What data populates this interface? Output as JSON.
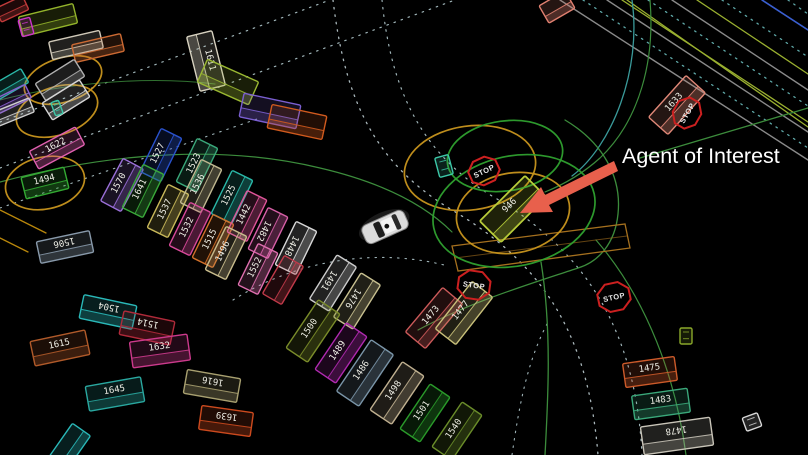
{
  "scene": {
    "background": "#000000",
    "description_label": "Agent of Interest"
  },
  "annotation": {
    "label": "Agent of Interest",
    "text_color": "#ffffff",
    "arrow_color": "#e8604c"
  },
  "colors": {
    "highlight_yellow": "#c8951e",
    "highlight_green": "#2fa12f",
    "stop_red": "#cc2020",
    "lane_dot": "#9fb4b8",
    "lane_green": "#3c8c3c",
    "lane_teal": "#3a9a9a",
    "lane_yellowgreen": "#9ab030",
    "lane_blue": "#3a5fd0",
    "lane_gray": "#8a8a8a",
    "crosswalk_orange": "#a5701e"
  },
  "ego": {
    "x": 385,
    "y": 227,
    "rot": 156
  },
  "stop_signs": [
    {
      "label": "STOP",
      "x": 484,
      "y": 171,
      "rot": -25,
      "r": 14
    },
    {
      "label": "STOP",
      "x": 474,
      "y": 285,
      "rot": 8,
      "r": 15
    },
    {
      "label": "STOP",
      "x": 614,
      "y": 297,
      "rot": -12,
      "r": 15
    },
    {
      "label": "STOP",
      "x": 687,
      "y": 113,
      "rot": -60,
      "r": 14
    }
  ],
  "highlight_ellipses": [
    {
      "x": 63,
      "y": 80,
      "rx": 40,
      "ry": 22,
      "rot": -18,
      "color": "#c8951e"
    },
    {
      "x": 57,
      "y": 111,
      "rx": 42,
      "ry": 24,
      "rot": -18,
      "color": "#c8951e"
    },
    {
      "x": 45,
      "y": 183,
      "rx": 40,
      "ry": 26,
      "rot": -12,
      "color": "#c8951e"
    },
    {
      "x": 470,
      "y": 168,
      "rx": 66,
      "ry": 42,
      "rot": -8,
      "color": "#c8951e"
    },
    {
      "x": 513,
      "y": 213,
      "rx": 57,
      "ry": 40,
      "rot": -10,
      "color": "#c8951e"
    },
    {
      "x": 514,
      "y": 211,
      "rx": 82,
      "ry": 55,
      "rot": -12,
      "color": "#2fa12f"
    },
    {
      "x": 505,
      "y": 156,
      "rx": 58,
      "ry": 35,
      "rot": -8,
      "color": "#2fa12f"
    }
  ],
  "agents": [
    {
      "id": "",
      "x": 12,
      "y": 9,
      "w": 30,
      "h": 15,
      "rot": -25,
      "color": "#c03a3a"
    },
    {
      "id": "",
      "x": 48,
      "y": 20,
      "w": 56,
      "h": 20,
      "rot": -14,
      "color": "#93b32b"
    },
    {
      "id": "",
      "x": 26,
      "y": 27,
      "w": 12,
      "h": 17,
      "rot": -15,
      "color": "#cc33cc"
    },
    {
      "id": "",
      "x": 76,
      "y": 45,
      "w": 52,
      "h": 18,
      "rot": -13,
      "color": "#cfc8b8"
    },
    {
      "id": "",
      "x": 98,
      "y": 48,
      "w": 50,
      "h": 18,
      "rot": -13,
      "color": "#cc6a33"
    },
    {
      "id": "",
      "x": 60,
      "y": 80,
      "w": 46,
      "h": 20,
      "rot": -32,
      "color": "#b0b0b0"
    },
    {
      "id": "",
      "x": 66,
      "y": 100,
      "w": 44,
      "h": 20,
      "rot": -32,
      "color": "#d5d5d5"
    },
    {
      "id": "",
      "x": 57,
      "y": 108,
      "w": 8,
      "h": 14,
      "rot": -20,
      "color": "#3cc8a8"
    },
    {
      "id": "",
      "x": 10,
      "y": 84,
      "w": 34,
      "h": 16,
      "rot": -30,
      "color": "#2ab8a8"
    },
    {
      "id": "",
      "x": 12,
      "y": 99,
      "w": 36,
      "h": 15,
      "rot": -26,
      "color": "#8a5fd0"
    },
    {
      "id": "",
      "x": 14,
      "y": 112,
      "w": 38,
      "h": 15,
      "rot": -22,
      "color": "#cfcfcf"
    },
    {
      "id": "1622",
      "x": 57,
      "y": 148,
      "w": 52,
      "h": 20,
      "rot": -28,
      "color": "#e060b0"
    },
    {
      "id": "1494",
      "x": 45,
      "y": 183,
      "w": 44,
      "h": 22,
      "rot": -14,
      "color": "#33aa33"
    },
    {
      "id": "1506",
      "x": 65,
      "y": 247,
      "w": 54,
      "h": 22,
      "rot": -12,
      "color": "#8899aa",
      "flip": true
    },
    {
      "id": "1611",
      "x": 206,
      "y": 61,
      "w": 56,
      "h": 26,
      "rot": 76,
      "color": "#d8d2c0"
    },
    {
      "id": "",
      "x": 228,
      "y": 82,
      "w": 56,
      "h": 25,
      "rot": 24,
      "color": "#9ab832"
    },
    {
      "id": "",
      "x": 270,
      "y": 111,
      "w": 58,
      "h": 24,
      "rot": 12,
      "color": "#7a5fd0"
    },
    {
      "id": "",
      "x": 297,
      "y": 122,
      "w": 56,
      "h": 24,
      "rot": 12,
      "color": "#d05a1e"
    },
    {
      "id": "",
      "x": 557,
      "y": 7,
      "w": 30,
      "h": 20,
      "rot": -30,
      "color": "#e08070"
    },
    {
      "id": "1570",
      "x": 122,
      "y": 185,
      "w": 48,
      "h": 23,
      "rot": -62,
      "color": "#9a6fd8"
    },
    {
      "id": "1527",
      "x": 161,
      "y": 155,
      "w": 48,
      "h": 23,
      "rot": -64,
      "color": "#2a52cc"
    },
    {
      "id": "1523",
      "x": 197,
      "y": 165,
      "w": 48,
      "h": 23,
      "rot": -64,
      "color": "#3aa87a"
    },
    {
      "id": "1641",
      "x": 143,
      "y": 191,
      "w": 48,
      "h": 23,
      "rot": -64,
      "color": "#3aa83a"
    },
    {
      "id": "1537",
      "x": 168,
      "y": 211,
      "w": 48,
      "h": 23,
      "rot": -64,
      "color": "#c8b85a"
    },
    {
      "id": "1536",
      "x": 201,
      "y": 186,
      "w": 48,
      "h": 23,
      "rot": -64,
      "color": "#c0b890"
    },
    {
      "id": "1525",
      "x": 232,
      "y": 197,
      "w": 48,
      "h": 23,
      "rot": -64,
      "color": "#2ab8a8"
    },
    {
      "id": "1532",
      "x": 190,
      "y": 229,
      "w": 48,
      "h": 23,
      "rot": -64,
      "color": "#d84a9a"
    },
    {
      "id": "1515",
      "x": 213,
      "y": 241,
      "w": 48,
      "h": 23,
      "rot": -64,
      "color": "#d0702a"
    },
    {
      "id": "1442",
      "x": 247,
      "y": 216,
      "w": 46,
      "h": 22,
      "rot": -64,
      "color": "#e0559a"
    },
    {
      "id": "1496",
      "x": 226,
      "y": 253,
      "w": 48,
      "h": 23,
      "rot": -64,
      "color": "#c8bc8c"
    },
    {
      "id": "1482",
      "x": 268,
      "y": 233,
      "w": 46,
      "h": 22,
      "rot": -64,
      "color": "#d860a8",
      "flip": true
    },
    {
      "id": "1448",
      "x": 296,
      "y": 248,
      "w": 48,
      "h": 23,
      "rot": -64,
      "color": "#d8d8d8",
      "flip": true
    },
    {
      "id": "1552",
      "x": 258,
      "y": 269,
      "w": 46,
      "h": 22,
      "rot": -64,
      "color": "#e070b0"
    },
    {
      "id": "",
      "x": 283,
      "y": 280,
      "w": 44,
      "h": 22,
      "rot": -60,
      "color": "#c03a4a"
    },
    {
      "id": "1491",
      "x": 333,
      "y": 283,
      "w": 52,
      "h": 23,
      "rot": -58,
      "color": "#cccccc",
      "flip": true
    },
    {
      "id": "1476",
      "x": 357,
      "y": 301,
      "w": 52,
      "h": 23,
      "rot": -58,
      "color": "#c8c090",
      "flip": true
    },
    {
      "id": "1500",
      "x": 313,
      "y": 331,
      "w": 58,
      "h": 26,
      "rot": -56,
      "color": "#7a8c2a"
    },
    {
      "id": "1489",
      "x": 341,
      "y": 353,
      "w": 56,
      "h": 25,
      "rot": -56,
      "color": "#b02ab0"
    },
    {
      "id": "1486",
      "x": 365,
      "y": 373,
      "w": 62,
      "h": 27,
      "rot": -56,
      "color": "#7a95a8"
    },
    {
      "id": "1498",
      "x": 397,
      "y": 393,
      "w": 58,
      "h": 26,
      "rot": -56,
      "color": "#c0b090"
    },
    {
      "id": "1501",
      "x": 425,
      "y": 413,
      "w": 54,
      "h": 24,
      "rot": -56,
      "color": "#2a9a2a"
    },
    {
      "id": "1540",
      "x": 457,
      "y": 431,
      "w": 54,
      "h": 24,
      "rot": -56,
      "color": "#6a8c2a"
    },
    {
      "id": "1504",
      "x": 108,
      "y": 312,
      "w": 54,
      "h": 24,
      "rot": 12,
      "color": "#2ab8b8",
      "flip": true
    },
    {
      "id": "1514",
      "x": 147,
      "y": 328,
      "w": 52,
      "h": 24,
      "rot": 12,
      "color": "#b02a3a",
      "flip": true
    },
    {
      "id": "1615",
      "x": 60,
      "y": 348,
      "w": 56,
      "h": 25,
      "rot": -12,
      "color": "#b05a2a"
    },
    {
      "id": "1632",
      "x": 160,
      "y": 351,
      "w": 58,
      "h": 26,
      "rot": -8,
      "color": "#cc3a8c"
    },
    {
      "id": "1645",
      "x": 115,
      "y": 394,
      "w": 56,
      "h": 25,
      "rot": -10,
      "color": "#2aa8a0"
    },
    {
      "id": "1616",
      "x": 212,
      "y": 386,
      "w": 54,
      "h": 24,
      "rot": 10,
      "color": "#a8a070",
      "flip": true
    },
    {
      "id": "1639",
      "x": 226,
      "y": 421,
      "w": 52,
      "h": 24,
      "rot": 8,
      "color": "#cc4a1e",
      "flip": true
    },
    {
      "id": "",
      "x": 70,
      "y": 446,
      "w": 40,
      "h": 22,
      "rot": -55,
      "color": "#2ab8b8"
    },
    {
      "id": "1473",
      "x": 434,
      "y": 318,
      "w": 58,
      "h": 26,
      "rot": -50,
      "color": "#cc5a5a"
    },
    {
      "id": "1477",
      "x": 464,
      "y": 313,
      "w": 60,
      "h": 26,
      "rot": -52,
      "color": "#c8c07a"
    },
    {
      "id": "946",
      "x": 513,
      "y": 209,
      "w": 64,
      "h": 30,
      "rot": -45,
      "color": "#b8cc3a",
      "aoi": true
    },
    {
      "id": "1633",
      "x": 677,
      "y": 105,
      "w": 56,
      "h": 26,
      "rot": -48,
      "color": "#e08878"
    },
    {
      "id": "1475",
      "x": 650,
      "y": 372,
      "w": 52,
      "h": 24,
      "rot": -8,
      "color": "#cc5a2a"
    },
    {
      "id": "1483",
      "x": 661,
      "y": 404,
      "w": 56,
      "h": 24,
      "rot": -8,
      "color": "#3aa87a"
    },
    {
      "id": "1478",
      "x": 677,
      "y": 436,
      "w": 70,
      "h": 28,
      "rot": -8,
      "color": "#c8c4b8",
      "flip": true
    },
    {
      "id": "",
      "x": 752,
      "y": 422,
      "w": 16,
      "h": 14,
      "rot": -20,
      "color": "#d8d8d8"
    },
    {
      "id": "",
      "x": 686,
      "y": 336,
      "w": 12,
      "h": 16,
      "rot": 0,
      "color": "#8aa82a"
    },
    {
      "id": "",
      "x": 444,
      "y": 166,
      "w": 14,
      "h": 20,
      "rot": -15,
      "color": "#3cc8a8"
    }
  ]
}
